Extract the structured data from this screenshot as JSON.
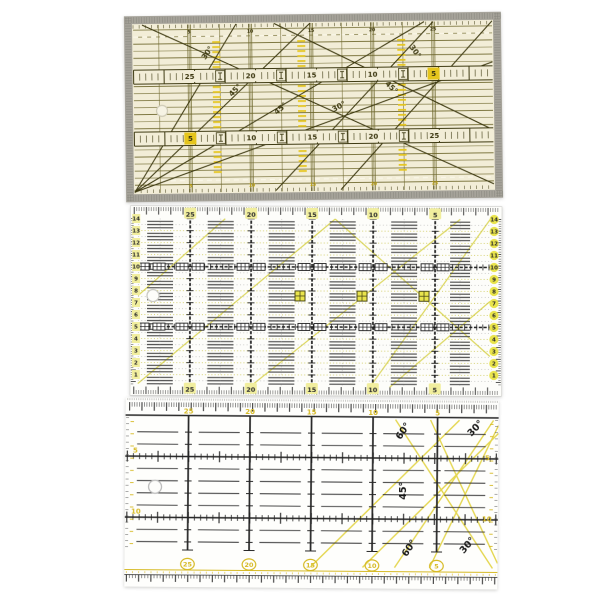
{
  "photo": {
    "description": "Product photo of three transparent quilting patchwork rulers stacked vertically",
    "background": "#ffffff"
  },
  "top_ruler": {
    "name": "olive tinted quilting ruler with metal edges",
    "colors": {
      "edge": "#a6a39a",
      "hatch": "#84837a",
      "body": "#f2edd7",
      "line": "#6e672d",
      "dark": "#3e3a12",
      "accent": "#e5c51c",
      "text": "#3a350e",
      "scale_yellow": "#bfa312",
      "white_dash": "#faf7e8"
    },
    "tape_upper_numbers": [
      "25",
      "20",
      "15",
      "10",
      "5"
    ],
    "tape_lower_numbers": [
      "5",
      "10",
      "15",
      "20",
      "25"
    ],
    "edge_scale_top": [
      "5",
      "10",
      "15",
      "20",
      "25"
    ],
    "edge_scale_bottom": [
      "5",
      "10",
      "15",
      "20",
      "25"
    ],
    "highlighted_number": "5",
    "angle_labels": [
      "30°",
      "45°",
      "45°",
      "30°",
      "45°",
      "30°"
    ]
  },
  "middle_ruler": {
    "name": "white 15x30 cm grid ruler with yellow bias lines",
    "colors": {
      "body": "#fdfdfa",
      "ink": "#1f1f1f",
      "dash_grey": "#4b4b4b",
      "row_yellow": "#c9c448",
      "diagonal": "#dcd75e",
      "chip": "#f1ee9e",
      "circle": "#e9e44c",
      "number": "#2b2b2b"
    },
    "top_numbers": [
      "25",
      "20",
      "15",
      "10",
      "5"
    ],
    "bottom_numbers": [
      "25",
      "20",
      "15",
      "10",
      "5"
    ],
    "left_numbers": [
      "14",
      "13",
      "12",
      "11",
      "10",
      "9",
      "8",
      "7",
      "6",
      "5",
      "4",
      "3",
      "2",
      "1"
    ],
    "right_numbers": [
      "14",
      "13",
      "12",
      "11",
      "10",
      "9",
      "8",
      "7",
      "6",
      "5",
      "4",
      "3",
      "2",
      "1"
    ]
  },
  "bottom_ruler": {
    "name": "clear quilting ruler with 30/45/60 degree angle lines",
    "colors": {
      "body": "#fefefc",
      "ink": "#272727",
      "yellow": "#d6ba24",
      "diagonal": "#e4d64f",
      "micro": "#9a9a96"
    },
    "top_numbers": [
      "25",
      "20",
      "15",
      "10",
      "5"
    ],
    "bottom_numbers": [
      "25",
      "20",
      "15",
      "10",
      "5"
    ],
    "left_numbers": [
      "5",
      "10"
    ],
    "right_numbers": [
      "5",
      "10"
    ],
    "angle_labels": [
      "60°",
      "30°",
      "45°",
      "60°",
      "30°"
    ]
  }
}
